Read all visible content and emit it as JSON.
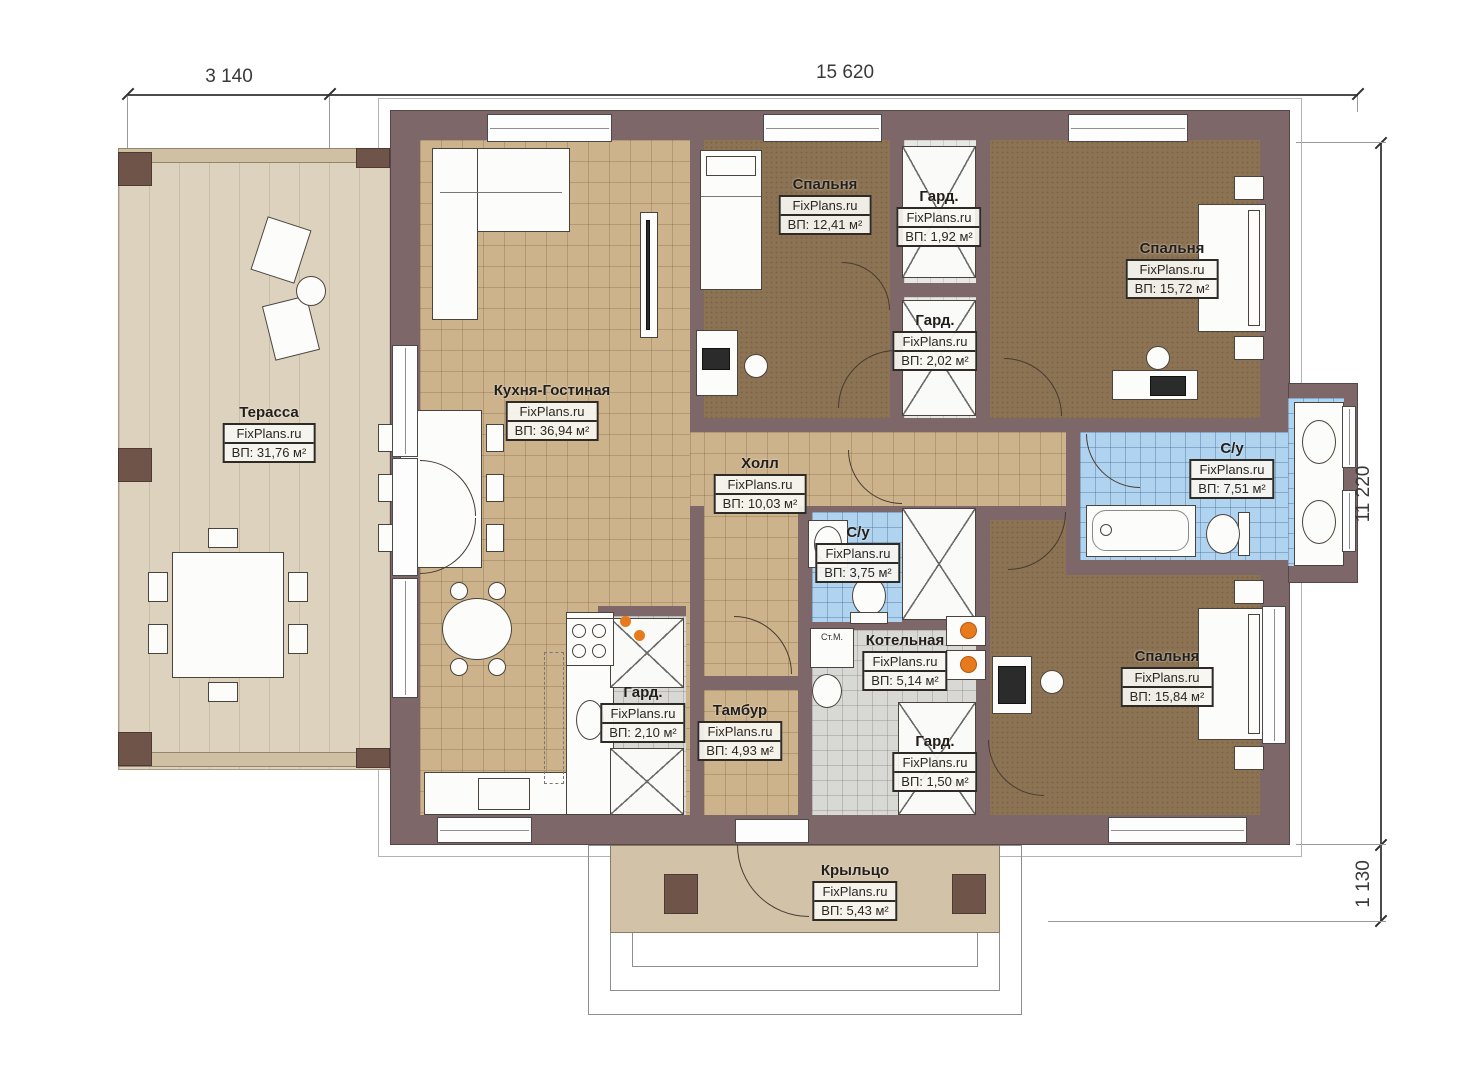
{
  "dimensions": {
    "top_left": "3 140",
    "top_main": "15 620",
    "right_main": "11 220",
    "right_porch": "1 130"
  },
  "rooms": [
    {
      "id": "terrace",
      "name": "Терасса",
      "brand": "FixPlans.ru",
      "area": "ВП: 31,76 м²"
    },
    {
      "id": "kitchen-living",
      "name": "Кухня-Гостиная",
      "brand": "FixPlans.ru",
      "area": "ВП: 36,94 м²"
    },
    {
      "id": "bedroom-1",
      "name": "Спальня",
      "brand": "FixPlans.ru",
      "area": "ВП: 12,41 м²"
    },
    {
      "id": "wardrobe-1",
      "name": "Гард.",
      "brand": "FixPlans.ru",
      "area": "ВП: 1,92 м²"
    },
    {
      "id": "wardrobe-2",
      "name": "Гард.",
      "brand": "FixPlans.ru",
      "area": "ВП: 2,02 м²"
    },
    {
      "id": "bedroom-2",
      "name": "Спальня",
      "brand": "FixPlans.ru",
      "area": "ВП: 15,72 м²"
    },
    {
      "id": "hall",
      "name": "Холл",
      "brand": "FixPlans.ru",
      "area": "ВП: 10,03 м²"
    },
    {
      "id": "bathroom-1",
      "name": "С/у",
      "brand": "FixPlans.ru",
      "area": "ВП: 7,51 м²"
    },
    {
      "id": "bathroom-2",
      "name": "С/у",
      "brand": "FixPlans.ru",
      "area": "ВП: 3,75 м²"
    },
    {
      "id": "boiler-room",
      "name": "Котельная",
      "brand": "FixPlans.ru",
      "area": "ВП: 5,14 м²"
    },
    {
      "id": "wardrobe-3",
      "name": "Гард.",
      "brand": "FixPlans.ru",
      "area": "ВП: 2,10 м²"
    },
    {
      "id": "vestibule",
      "name": "Тамбур",
      "brand": "FixPlans.ru",
      "area": "ВП: 4,93 м²"
    },
    {
      "id": "wardrobe-4",
      "name": "Гард.",
      "brand": "FixPlans.ru",
      "area": "ВП: 1,50 м²"
    },
    {
      "id": "bedroom-3",
      "name": "Спальня",
      "brand": "FixPlans.ru",
      "area": "ВП: 15,84 м²"
    },
    {
      "id": "porch",
      "name": "Крыльцо",
      "brand": "FixPlans.ru",
      "area": "ВП: 5,43 м²"
    }
  ],
  "annotations": {
    "washing_machine": "Ст.М."
  },
  "colors": {
    "wall": "#7d6769",
    "floor_tan": "#ccb38c",
    "floor_brown": "#8c7354",
    "floor_blue": "#b0d4f0",
    "floor_gray": "#d8d8d5",
    "terrace": "#ddd2be",
    "porch": "#d2c2a8",
    "accent_orange": "#e87a1e"
  }
}
